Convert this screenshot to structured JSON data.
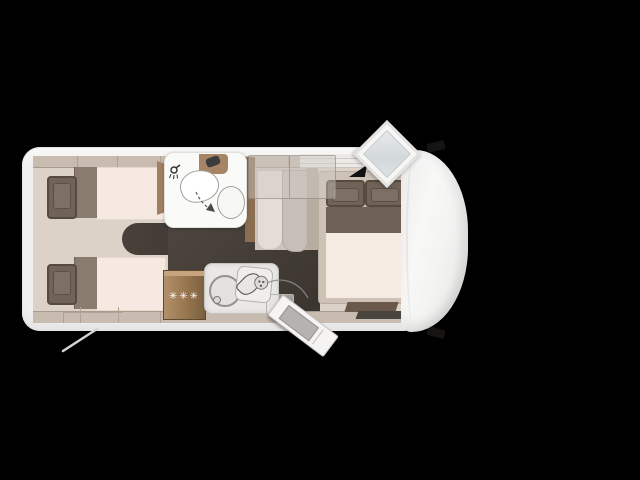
{
  "palette": {
    "bg-black": "#000000",
    "body-white": "#f1f0ee",
    "wall-beige": "#c8bbaf",
    "wall-line": "#a89b8e",
    "interior-beige": "#dcd2c8",
    "floor-dark": "#48413a",
    "floor-darker": "#3b352f",
    "mattress-cream": "#f5e9e1",
    "pillow-taupe": "#6f6257",
    "pillow-edge": "#554940",
    "headboard-taupe": "#8a7b6f",
    "bed-base": "#cec2b7",
    "duvet-taupe": "#6e6055",
    "wood": "#96764f",
    "wood-light": "#b3906a",
    "wood-dark": "#7a5f3f",
    "bath-white": "#fafaf8",
    "fixture-line": "#a39f9a",
    "counter-grey": "#eae8e5",
    "cab-white": "#f4f4f3",
    "hatch-glass": "#d3d8da",
    "curtain-light": "#e3ddd6",
    "curtain-dark": "#c7bfb7",
    "bench-brown": "#6a594a",
    "label-white": "#ffffff"
  },
  "kitchen": {
    "fridge_label": "✳✳✳"
  },
  "icons": {
    "shower": "shower-head-icon",
    "hatch": "roof-skylight-icon",
    "freezer_rating": "three-star-freezer-icon"
  }
}
